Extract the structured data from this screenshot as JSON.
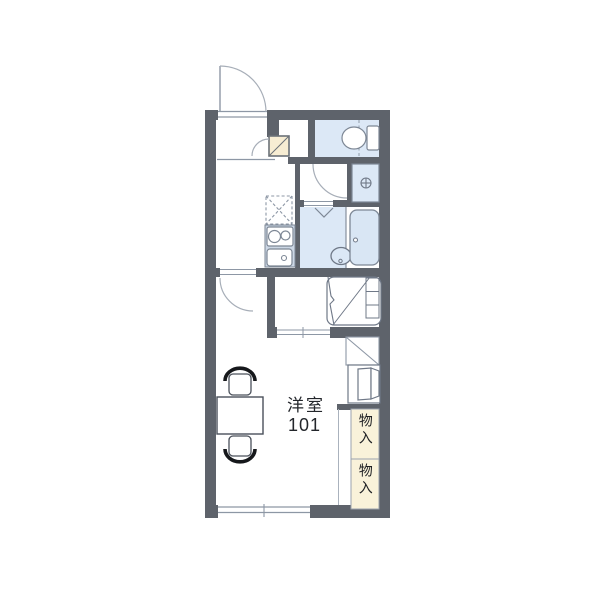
{
  "floor_plan": {
    "unit": {
      "room_label": "洋室",
      "room_number": "101"
    },
    "storage_closets": [
      {
        "label": "物入"
      },
      {
        "label": "物入"
      }
    ],
    "fixtures": [
      "entrance-door",
      "shoe-cabinet",
      "toilet",
      "washing-machine-pan",
      "refrigerator-space",
      "gas-stove",
      "kitchen-sink",
      "bathroom-vanity",
      "bathtub",
      "bifold-door-mark",
      "loft-ladder",
      "window",
      "dining-table",
      "chair",
      "storage-closet"
    ],
    "colors": {
      "wall": "#5e636b",
      "wet_area_fill": "#dce8f6",
      "counter_fill": "#ccd7e5",
      "storage_fill": "#f9f2da",
      "line": "#7d8795"
    }
  }
}
